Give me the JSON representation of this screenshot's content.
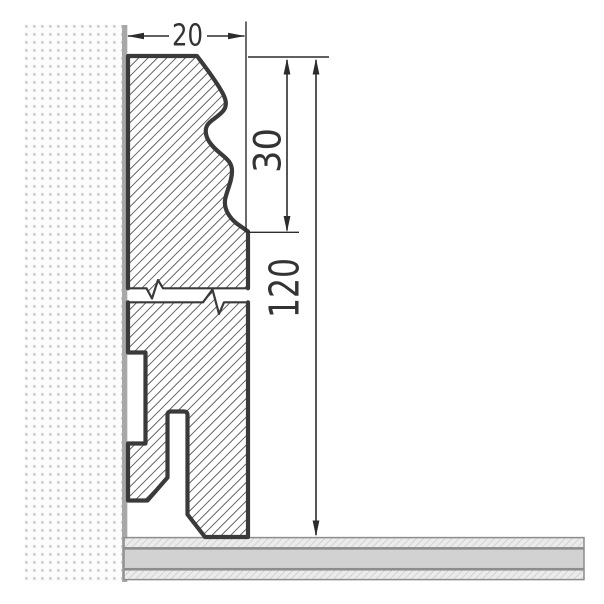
{
  "drawing": {
    "kind": "skirting-board-profile-section",
    "dimensions": {
      "profile_width": "20",
      "top_profile_height": "30",
      "total_height": "120"
    },
    "colors": {
      "background": "#ffffff",
      "outline": "#3a3a3a",
      "hatch_line": "#4a4a4a",
      "break_line": "#3a3a3a",
      "dimension_line": "#2c2c2c",
      "text": "#333333",
      "wall_background": "#fcfcfc",
      "wall_dot": "#cfcfcf",
      "wall_edge_strip": "#a8a8a8",
      "floor_band": "#d2d2d2",
      "floor_hatch_background": "#ebebeb",
      "floor_hatch_line": "#c3c3c3",
      "floor_border": "#8d8d8d"
    }
  }
}
